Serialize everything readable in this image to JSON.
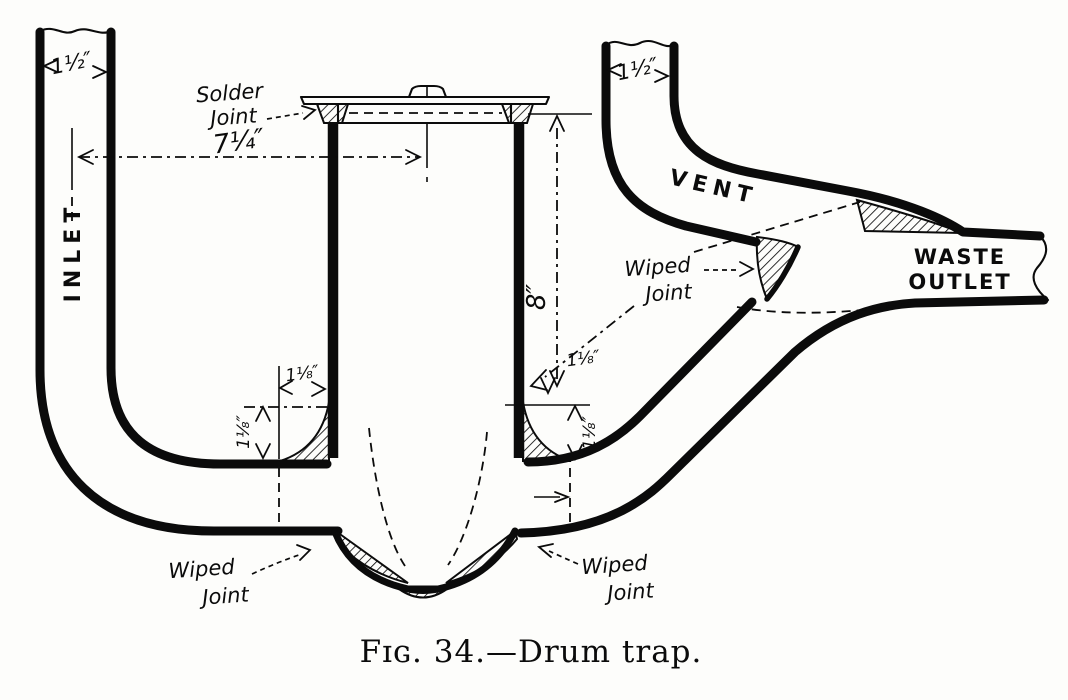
{
  "figure": {
    "caption": "Fɪɢ. 34.—Drum trap.",
    "labels": {
      "inlet": "INLET",
      "vent": "VENT",
      "waste_line1": "WASTE",
      "waste_line2": "OUTLET"
    },
    "annotations": {
      "solder_joint": {
        "line1": "Solder",
        "line2": "Joint"
      },
      "wiped_joint": {
        "line1": "Wiped",
        "line2": "Joint"
      }
    },
    "dimensions": {
      "inlet_width": "1½″",
      "vent_width": "1½″",
      "center_to_center": "7¼″",
      "drum_height": "8″",
      "fillet_left_horizontal": "1⅛″",
      "fillet_left_vertical": "1⅛″",
      "fillet_right_horizontal": "1⅛″",
      "fillet_right_vertical": "1⅛″"
    }
  }
}
